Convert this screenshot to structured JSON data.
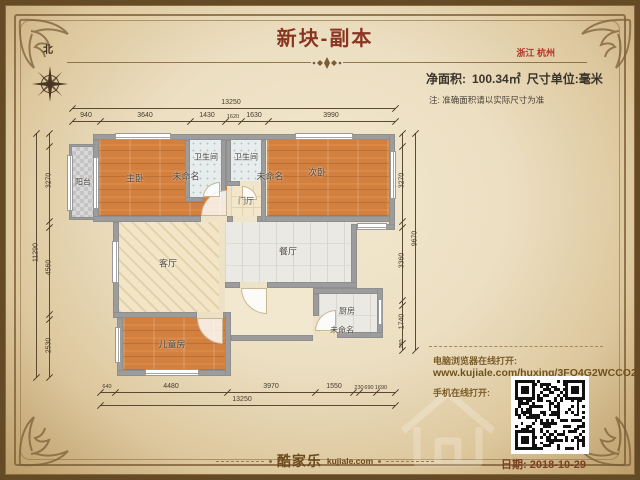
{
  "header": {
    "title": "新块-副本",
    "location": "浙江 杭州",
    "area_label": "净面积:",
    "area_value": "100.34㎡",
    "unit_label": "尺寸单位:毫米",
    "note": "注: 准确面积请以实际尺寸为准"
  },
  "compass": {
    "north_label": "北"
  },
  "plan": {
    "rooms": [
      "阳台",
      "主卧",
      "未命名",
      "卫生间",
      "卫生间",
      "未命名",
      "次卧",
      "门厅",
      "客厅",
      "餐厅",
      "厨房",
      "儿童房",
      "未命名"
    ],
    "dimensions": {
      "top_total": "13250",
      "top_segments": [
        "940",
        "3640",
        "1430",
        "1620",
        "1630",
        "3990"
      ],
      "bottom_total": "13250",
      "bottom_segments": [
        "640",
        "4480",
        "3970",
        "1550",
        "230",
        "690",
        "1690"
      ],
      "left_total": "11290",
      "left_segments": [
        "3270",
        "4560",
        "2530"
      ],
      "right_total": "9670",
      "right_segments": [
        "3270",
        "3360",
        "1740",
        "180"
      ]
    }
  },
  "share": {
    "desktop_label": "电脑浏览器在线打开:",
    "url": "www.kujiale.com/huxing/3FO4G2WCCO2C",
    "mobile_label": "手机在线打开:"
  },
  "footer": {
    "brand": "酷家乐",
    "brand_domain": "kujiale.com",
    "date": "日期: 2018-10-29"
  },
  "colors": {
    "accent_red": "#8b3422",
    "brand_brown": "#6b4a1e",
    "wall_gray": "#9c9c9c",
    "wood_orange": "#d2803f",
    "bath_tile": "#e7eced",
    "hall_beige": "#f2e7ca"
  }
}
